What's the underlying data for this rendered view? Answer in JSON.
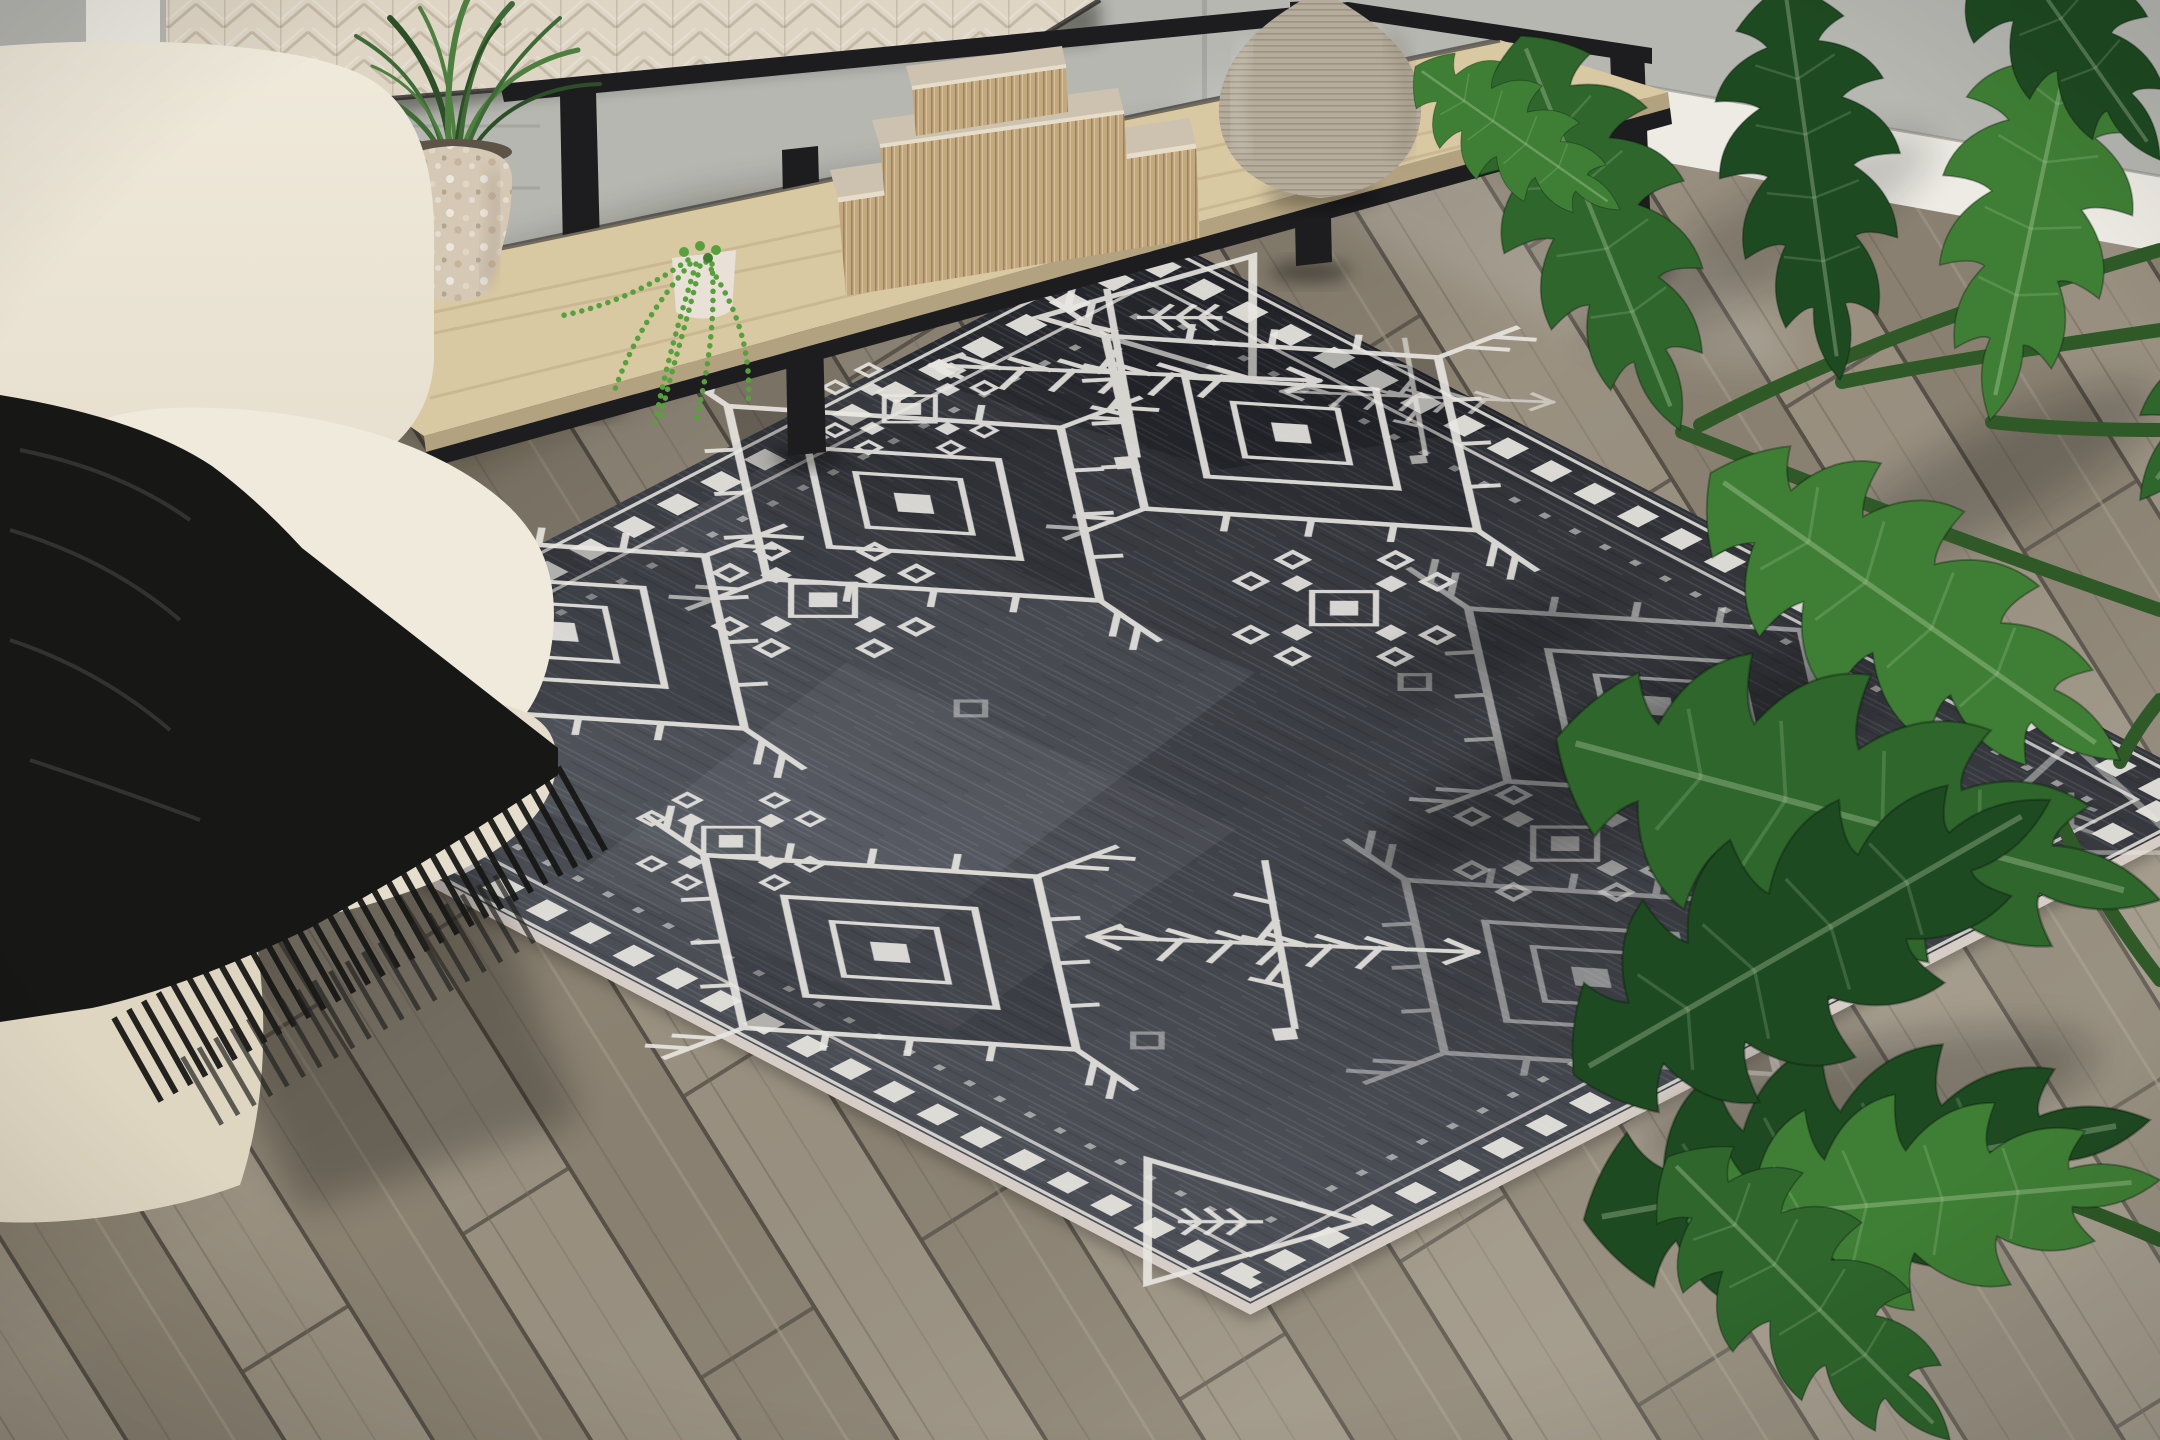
{
  "meta": {
    "title": "Living room product photo of a charcoal tribal area rug"
  },
  "scene": {
    "description": "Dark charcoal distressed area rug with white tribal motifs laid diagonally on gray wood plank flooring; cream linen sofa with black fringed throw blanket at left; black metal console table with whitewashed wood top and light wood shelf holding a grass plant in a mosaic pot, a trailing string-of-pearls succulent, stacked beige book boxes and a ribbed stone vase; gray wall with white baseboard behind; large split-leaf philodendron foliage entering from the right",
    "objects": [
      {
        "name": "rug",
        "label": "Charcoal tribal-pattern area rug with white motifs"
      },
      {
        "name": "sofa",
        "label": "Cream linen sofa"
      },
      {
        "name": "throw-blanket",
        "label": "Black fringed throw blanket"
      },
      {
        "name": "console-table",
        "label": "Black metal console table with whitewashed top"
      },
      {
        "name": "grass-plant",
        "label": "Grass plant in mosaic pot"
      },
      {
        "name": "string-of-pearls",
        "label": "String of pearls succulent"
      },
      {
        "name": "book-boxes",
        "label": "Stacked decorative book boxes"
      },
      {
        "name": "vase",
        "label": "Ribbed stone vase"
      },
      {
        "name": "philodendron",
        "label": "Split-leaf philodendron plant"
      },
      {
        "name": "wood-floor",
        "label": "Gray wood plank floor"
      },
      {
        "name": "wall",
        "label": "Gray wall with white baseboard"
      }
    ],
    "rug_motifs": [
      "hooked diamond medallion",
      "stepped snowflake cluster",
      "crossed fir-branch sprig",
      "corner triangle with tree glyph",
      "checkered diamond border"
    ]
  },
  "colors": {
    "wall": "#b6b7b1",
    "baseboard": "#edebe4",
    "floor-base": "#948c7c",
    "plank-a": "#9a9181",
    "plank-b": "#8b8272",
    "plank-gap": "#565047",
    "rug-field": "#3c3e44",
    "rug-pattern": "#e9e7e1",
    "rug-binding": "#d7cdc7",
    "sofa-light": "#f0eadc",
    "sofa-mid": "#e6decd",
    "sofa-dark": "#dfd6c2",
    "blanket": "#171715",
    "metal": "#1d1d1f",
    "whitewash": "#ded5c5",
    "shelf-wood": "#d9c9a3",
    "shelf-edge": "#b3a27f",
    "vase": "#b5ac9b",
    "boxes": "#cdc2b0",
    "box-pages": "#c2a87e",
    "pot-mosaic": "#d5c9b6",
    "pot-small": "#e9e1d7",
    "grass-green": "#3e6b35",
    "pearls-green": "#57a13d",
    "leaf-dark": "#1e4a21",
    "leaf-mid": "#2e662c",
    "leaf-light": "#3f7f35",
    "stem-green": "#2f5a28"
  }
}
